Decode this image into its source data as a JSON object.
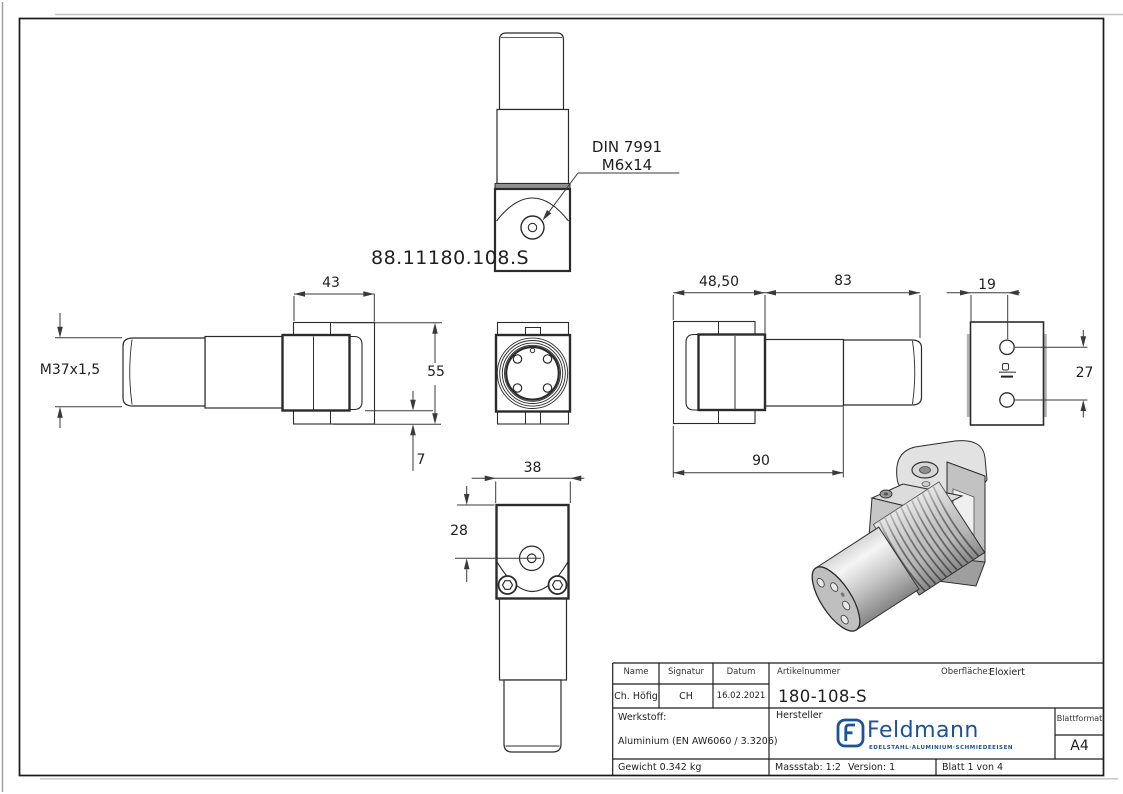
{
  "drawing": {
    "part_label": "88.11180.108.S",
    "callout_line1": "DIN 7991",
    "callout_line2": "M6x14",
    "dim_43": "43",
    "dim_m37": "M37x1,5",
    "dim_55": "55",
    "dim_7": "7",
    "dim_38": "38",
    "dim_28": "28",
    "dim_48_50": "48,50",
    "dim_83": "83",
    "dim_90": "90",
    "dim_19": "19",
    "dim_27": "27"
  },
  "title_block": {
    "name_label": "Name",
    "signatur_label": "Signatur",
    "datum_label": "Datum",
    "artikelnummer_label": "Artikelnummer",
    "oberflaeche_label": "Oberfläche:",
    "oberflaeche_value": "Eloxiert",
    "name_value": "Ch. Höfig",
    "signatur_value": "CH",
    "datum_value": "16.02.2021",
    "artikelnummer_value": "180-108-S",
    "werkstoff_label": "Werkstoff:",
    "werkstoff_value": "Aluminium (EN AW6060 / 3.3206)",
    "hersteller_label": "Hersteller",
    "blattformat_label": "Blattformat",
    "blattformat_value": "A4",
    "gewicht": "Gewicht 0.342 kg",
    "massstab": "Massstab: 1:2",
    "version": "Version: 1",
    "blatt": "Blatt 1 von 4"
  },
  "logo": {
    "name": "Feldmann",
    "tagline": "EDELSTAHL·ALUMINIUM·SCHMIEDEEISEN"
  },
  "colors": {
    "logo_blue": "#1d5296",
    "line": "#2b2b2b",
    "dim": "#3a3a3a"
  }
}
